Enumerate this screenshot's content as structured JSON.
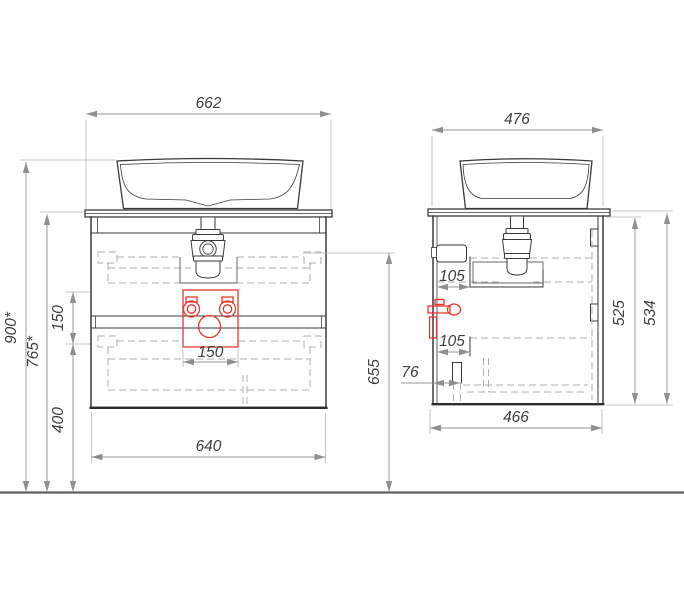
{
  "colors": {
    "outline": "#3a3a3a",
    "hidden_line": "#aeaeae",
    "dimension_line": "#949494",
    "text": "#3f3f3f",
    "highlight": "#e0382c"
  },
  "dimensions": {
    "front": {
      "top_width": "662",
      "overall_height": "900*",
      "counter_height": "765*",
      "connection_zone_height": "150",
      "bottom_clearance": "400",
      "connection_zone_width": "150",
      "cabinet_width": "640",
      "handle_height": "655"
    },
    "side": {
      "top_depth": "476",
      "upper_offset": "105",
      "lower_offset": "105",
      "drain_offset": "76",
      "cabinet_height": "525",
      "total_height": "534",
      "cabinet_depth": "466"
    }
  }
}
